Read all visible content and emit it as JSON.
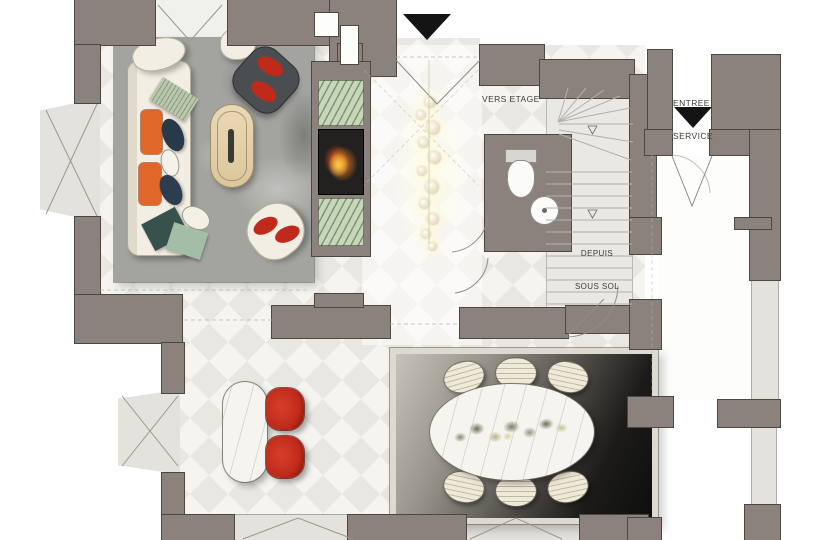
{
  "labels": {
    "to_upper_floor": "VERS ETAGE",
    "from_basement_line1": "DEPUIS",
    "from_basement_line2": "SOUS SOL",
    "service_entrance_line1": "ENTREE",
    "service_entrance_line2": "SERVICE"
  },
  "icons": {
    "main_entry_arrow": "filled-triangle-down",
    "service_entry_arrow": "filled-triangle-down",
    "stair_up_marker": "outline-triangle-down",
    "stair_down_marker": "outline-triangle-down"
  },
  "colors": {
    "wall": "#8b827d",
    "wall_outline": "#4d4741",
    "floor_base": "#f5f4f0",
    "floor_stripe": "#e9e7e1",
    "glazing": "#e4e2dd",
    "rug_living": "#a3a49f",
    "sofa_cream": "#f2eee3",
    "cushion_orange": "#e0662a",
    "chair_red": "#c02a1a",
    "bench_green": "#c8d7ba",
    "flame_orange": "#ee7b1f",
    "wood_table": "#e7d7b2",
    "stair_tread": "#e9e8e5",
    "arrow_black": "#141414"
  }
}
